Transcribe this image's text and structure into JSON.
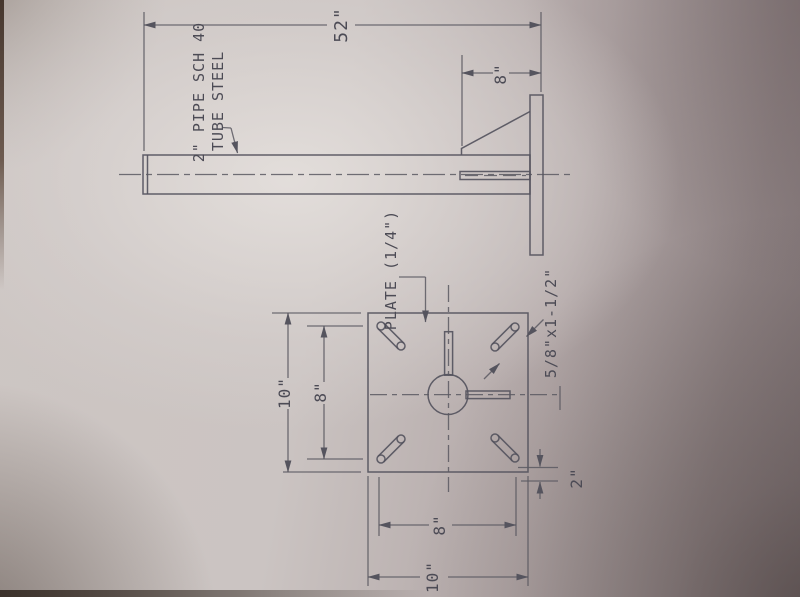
{
  "photo": {
    "description": "Photograph of a drafted engineering drawing on paper (sheet rotated 90 degrees)",
    "paper_color": "#cdc6c3",
    "line_color": "#55545e",
    "vignette_color": "#3f352f"
  },
  "side_view": {
    "length_dim": "52\"",
    "gusset_dim": "8\"",
    "pipe_label_line1": "2\" PIPE SCH 40",
    "pipe_label_line2": "TUBE STEEL"
  },
  "plan_view": {
    "plate_label": "PLATE (1/4\")",
    "slot_label": "5/8\"x1-1/2\"",
    "left_outer_dim": "10\"",
    "left_inner_dim": "8\"",
    "bottom_inner_dim": "8\"",
    "bottom_outer_dim": "10\"",
    "corner_offset_dim": "2\""
  }
}
